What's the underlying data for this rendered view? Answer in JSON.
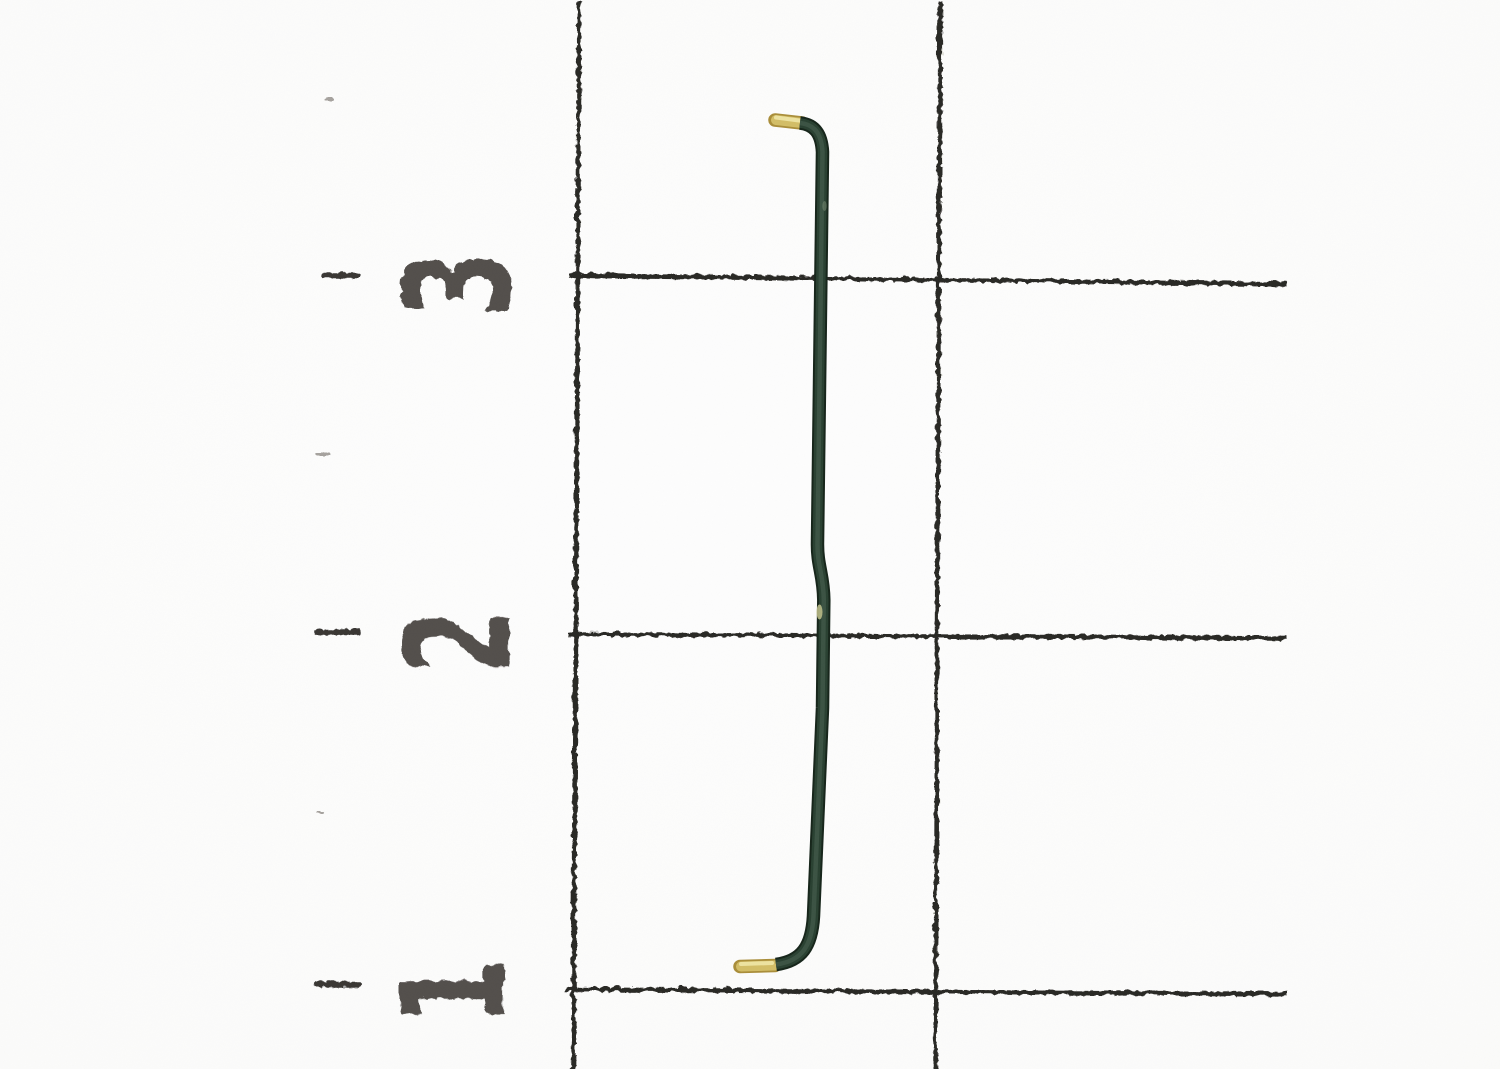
{
  "scene": {
    "type": "photograph",
    "subject": "Dark green pre-formed wire jumper with stripped brass ends photographed on centimeter ruler grid paper",
    "background_color": "#fcfcfb",
    "paper_shade_color": "#f5f5f2"
  },
  "grid": {
    "line_color": "#2b2926",
    "line_width": 4.6,
    "lines": [
      {
        "name": "grid-vertical-line-1",
        "x1": 578,
        "y1": 0,
        "x2": 572,
        "y2": 1069
      },
      {
        "name": "grid-vertical-line-2",
        "x1": 939,
        "y1": 0,
        "x2": 934,
        "y2": 1069
      },
      {
        "name": "grid-horizontal-line-3",
        "x1": 567,
        "y1": 274,
        "x2": 1286,
        "y2": 283
      },
      {
        "name": "grid-horizontal-line-2",
        "x1": 567,
        "y1": 633,
        "x2": 1286,
        "y2": 637
      },
      {
        "name": "grid-horizontal-line-1",
        "x1": 564,
        "y1": 988,
        "x2": 1286,
        "y2": 993
      }
    ]
  },
  "ruler": {
    "tick_color": "#3a3836",
    "tick_width": 5.5,
    "minor_tick_color": "#98958f",
    "minor_tick_width": 3,
    "label_color": "#474340",
    "label_font_size": 145,
    "label_scale_x": 0.66,
    "label_rotation_deg": -90,
    "marks": [
      {
        "label": "3",
        "label_cx": 457,
        "label_cy": 282,
        "tick_x1": 322,
        "tick_x2": 356,
        "tick_y": 274
      },
      {
        "label": "2",
        "label_cx": 457,
        "label_cy": 640,
        "tick_x1": 317,
        "tick_x2": 357,
        "tick_y": 631
      },
      {
        "label": "1",
        "label_cx": 452,
        "label_cy": 990,
        "tick_x1": 315,
        "tick_x2": 358,
        "tick_y": 983
      }
    ],
    "minor_ticks": [
      {
        "x1": 325,
        "x2": 331,
        "y": 98
      },
      {
        "x1": 317,
        "x2": 327,
        "y": 453
      },
      {
        "x1": 316,
        "x2": 322,
        "y": 812
      }
    ]
  },
  "wire": {
    "description": "Green insulated wire with right-angle bend at top and bottom, bare brass tips pointing left",
    "insulation_outline_color": "#18271c",
    "insulation_color": "#2b4233",
    "insulation_highlight_color": "#4d6553",
    "tip_outline_color": "#ab8f3b",
    "tip_color": "#d4bf68",
    "tip_highlight_color": "#f0e7a6",
    "thickness": 13.5,
    "green_path": "M 800 123 C 814 124.5 821.5 133 822.5 152 L 817.5 542 C 817 566 823.5 574 823.8 600 L 822.5 708 L 813.5 916 C 811.8 946 802 961 776 964.5",
    "top_tip": {
      "x1": 775,
      "y1": 120,
      "x2": 802,
      "y2": 123
    },
    "bottom_tip": {
      "x1": 740,
      "y1": 966.5,
      "x2": 775,
      "y2": 965.5
    },
    "nicks": [
      {
        "cx": 819.5,
        "cy": 612,
        "rx": 3,
        "ry": 7.5,
        "color": "#c4c48e",
        "opacity": 0.85
      },
      {
        "cx": 824.5,
        "cy": 206,
        "rx": 2.2,
        "ry": 5,
        "color": "#7e8f78",
        "opacity": 0.5
      }
    ]
  }
}
